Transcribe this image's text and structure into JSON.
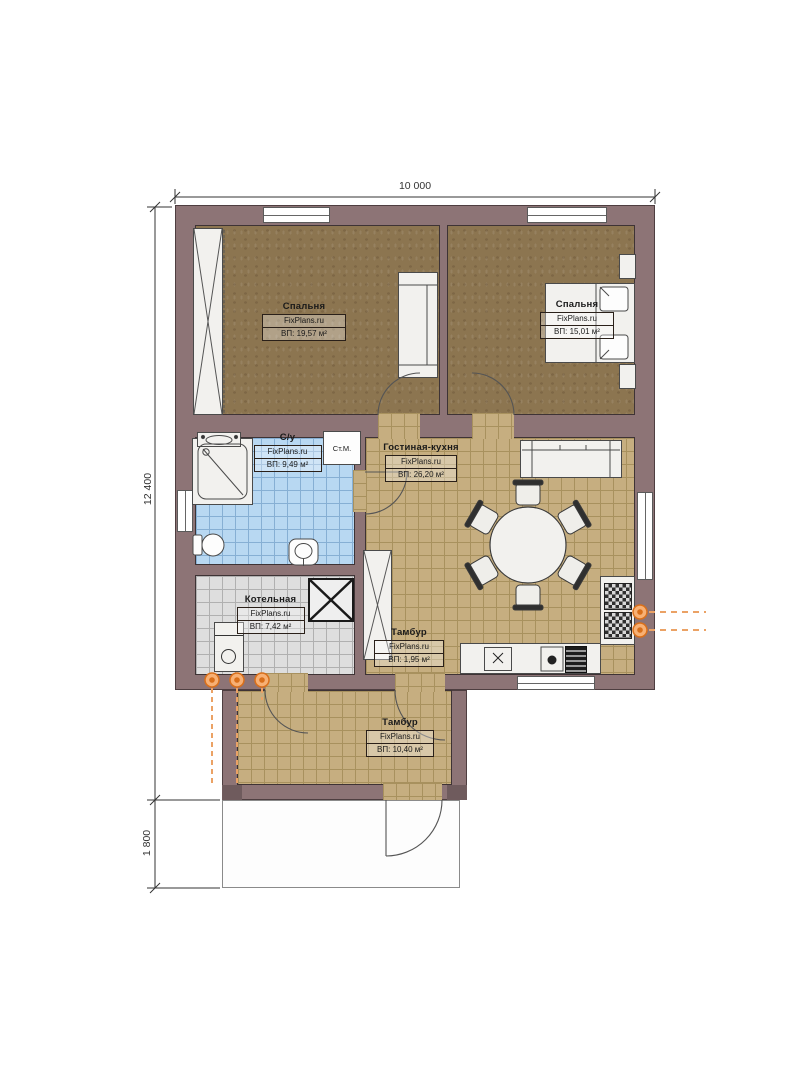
{
  "dimensions": {
    "width": "10 000",
    "height_main": "12 400",
    "height_porch": "1 800"
  },
  "rooms": [
    {
      "id": "bedroom-1",
      "name": "Спальня",
      "site": "FixPlans.ru",
      "area": "ВП: 19,57 м²"
    },
    {
      "id": "bedroom-2",
      "name": "Спальня",
      "site": "FixPlans.ru",
      "area": "ВП: 15,01 м²"
    },
    {
      "id": "bathroom",
      "name": "С/у",
      "site": "FixPlans.ru",
      "area": "ВП: 9,49 м²"
    },
    {
      "id": "living-kitchen",
      "name": "Гостиная-кухня",
      "site": "FixPlans.ru",
      "area": "ВП: 26,20 м²"
    },
    {
      "id": "boiler-room",
      "name": "Котельная",
      "site": "FixPlans.ru",
      "area": "ВП: 7,42 м²"
    },
    {
      "id": "vestibule-inner",
      "name": "Тамбур",
      "site": "FixPlans.ru",
      "area": "ВП: 1,95 м²"
    },
    {
      "id": "vestibule-entry",
      "name": "Тамбур",
      "site": "FixPlans.ru",
      "area": "ВП: 10,40 м²"
    }
  ],
  "labels": {
    "washing_machine": "Ст.М."
  },
  "colors": {
    "wall": "#8d7476",
    "bedroom_floor": "#8c7550",
    "tile_tan": "#c6ae80",
    "tile_blue": "#b8d8f2",
    "tile_gray": "#dedede",
    "utility_orange": "#d96f1a"
  }
}
